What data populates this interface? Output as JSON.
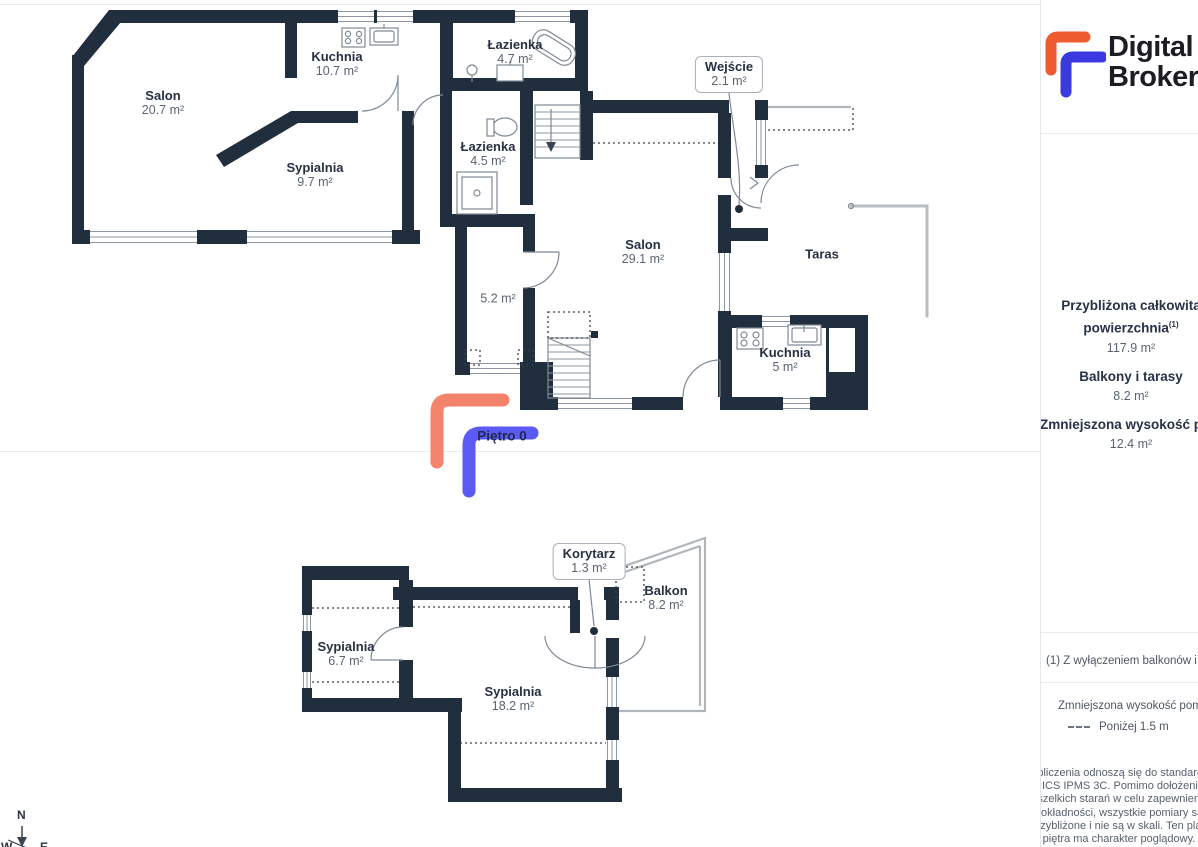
{
  "plans": {
    "floor_label": "Piętro 0",
    "top": {
      "rooms": {
        "salon": {
          "name": "Salon",
          "area": "20.7 m²"
        },
        "kuchnia": {
          "name": "Kuchnia",
          "area": "10.7 m²"
        },
        "sypialnia": {
          "name": "Sypialnia",
          "area": "9.7 m²"
        },
        "lazienka_gorna": {
          "name": "Łazienka",
          "area": "4.7 m²"
        },
        "lazienka_dolna": {
          "name": "Łazienka",
          "area": "4.5 m²"
        },
        "wejscie": {
          "name": "Wejście",
          "area": "2.1 m²"
        },
        "salon_duzy": {
          "name": "Salon",
          "area": "29.1 m²"
        },
        "kuchnia_mala": {
          "name": "Kuchnia",
          "area": "5 m²"
        },
        "taras": {
          "name": "Taras"
        },
        "korytarz_parter": {
          "area": "5.2 m²"
        }
      }
    },
    "bottom": {
      "rooms": {
        "korytarz": {
          "name": "Korytarz",
          "area": "1.3 m²"
        },
        "balkon": {
          "name": "Balkon",
          "area": "8.2 m²"
        },
        "sypialnia_mala": {
          "name": "Sypialnia",
          "area": "6.7 m²"
        },
        "sypialnia_duza": {
          "name": "Sypialnia",
          "area": "18.2 m²"
        }
      }
    }
  },
  "compass": {
    "n": "N",
    "w": "W",
    "e": "E"
  },
  "branding": {
    "name_line1": "Digital",
    "name_line2": "Broker"
  },
  "sidebar": {
    "summary": [
      {
        "label_line1": "Przybliżona całkowita",
        "label_line2": "powierzchnia",
        "sup": "(1)",
        "value": "117.9 m²"
      },
      {
        "label": "Balkony i tarasy",
        "value": "8.2 m²"
      },
      {
        "label": "Zmniejszona wysokość pomieszczeń",
        "value": "12.4 m²"
      }
    ],
    "footnote": "(1) Z wyłączeniem balkonów i tarasów",
    "legend": {
      "title": "Zmniejszona wysokość pomieszczeń",
      "item_label": "Poniżej 1.5 m"
    },
    "disclaimer_lines": [
      "Obliczenia odnoszą się do standardu",
      "RICS IPMS 3C. Pomimo dołożenia",
      "wszelkich starań w celu zapewnienia",
      "dokładności, wszystkie pomiary są",
      "przybliżone i nie są w skali. Ten plan",
      "piętra ma charakter poglądowy."
    ]
  },
  "colors": {
    "wall": "#202e3e",
    "floor_marker_orange": "#f4836b",
    "floor_marker_blue": "#5b5af5",
    "logo_orange": "#ee5b2e",
    "logo_blue": "#3a3ae0"
  }
}
